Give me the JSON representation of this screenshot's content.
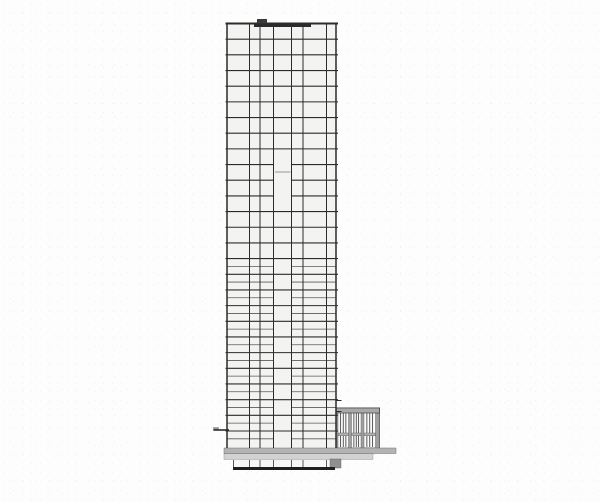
{
  "drawing": {
    "type": "architectural-section",
    "canvas": {
      "w": 600,
      "h": 502,
      "bg": "#fdfdfd"
    },
    "colors": {
      "line_dark": "#2b2b2b",
      "line_medium": "#5a5a5a",
      "line_light": "#8a8a8a",
      "fill_tower": "#f3f3f2",
      "fill_basement": "#f7f7f6",
      "fill_slab": "#b3b3b3",
      "fill_slab_light": "#d2d2d2",
      "fill_pier": "#9f9f9f",
      "fill_cap": "#a9a9a9",
      "fill_transom": "#b0b0b0",
      "fill_block": "#909090",
      "fill_bar": "#1f1f1f",
      "window_white": "#fbfbfb"
    },
    "tower": {
      "left": 227,
      "right": 336,
      "top": 23.5,
      "bottom": 431,
      "ground": 448,
      "floors": 27,
      "overhang": 1.5,
      "columns": [
        249.5,
        260,
        273.5,
        291.5,
        303,
        326.5
      ],
      "shaft": {
        "left": 273.5,
        "right": 291.5,
        "skip": [
          9,
          10,
          11
        ],
        "short_line_y": 172
      },
      "dense": {
        "top": 265,
        "bottom": 441,
        "offset": 7.8
      }
    },
    "roof": {
      "line_w": 2,
      "band": {
        "x": 254,
        "w": 57,
        "h": 3.5
      },
      "bulkhead": {
        "x": 257,
        "y": 19,
        "w": 10,
        "h": 4.5
      }
    },
    "canopy": {
      "x1": 213.5,
      "x2": 229,
      "y": 430,
      "block": {
        "x": 213.5,
        "y": 427.6,
        "w": 5,
        "h": 2.6
      }
    },
    "slab": {
      "x1": 224,
      "x2": 396,
      "y": 448,
      "h": 5.5,
      "step": {
        "x2": 373,
        "h": 6
      }
    },
    "basement": {
      "x1": 233,
      "x2": 335,
      "top": 448,
      "col_top": 460,
      "bottom": 467,
      "bar_h": 3,
      "block": {
        "x": 330,
        "y": 459,
        "w": 11,
        "h": 9
      }
    },
    "podium": {
      "x1": 336,
      "x2": 379.5,
      "top": 408,
      "bottom": 448,
      "cap_h": 5,
      "piers": [
        [
          336,
          338
        ],
        [
          348.5,
          351.5
        ],
        [
          361,
          364
        ],
        [
          375.5,
          379.5
        ]
      ],
      "transom": {
        "y": 433,
        "h": 2.8
      },
      "mullions": 3,
      "ticks": [
        400.5,
        411.5
      ],
      "tick_x2": 341.5
    }
  }
}
